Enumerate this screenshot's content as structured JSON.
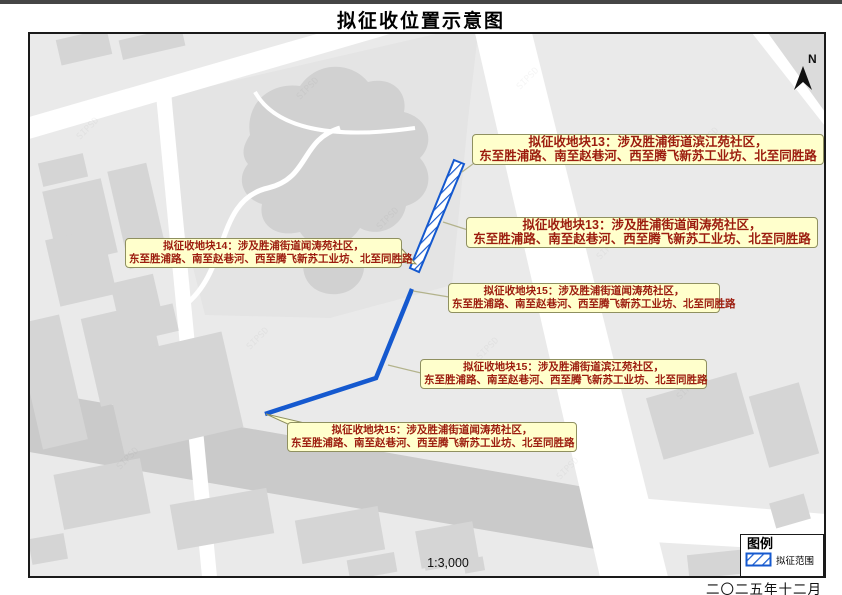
{
  "page": {
    "title": "拟征收位置示意图",
    "scale": "1:3,000",
    "north": "N",
    "date": "二〇二五年十二月"
  },
  "legend": {
    "title": "图例",
    "items": [
      {
        "label": "拟征范围",
        "swatch": "blue-diagonal-hatch"
      }
    ]
  },
  "map": {
    "watermark": "SIPSD",
    "callouts": [
      {
        "line1": "拟征收地块13：涉及胜浦街道滨江苑社区，",
        "line2": "东至胜浦路、南至赵巷河、西至腾飞新苏工业坊、北至同胜路"
      },
      {
        "line1": "拟征收地块13：涉及胜浦街道闻涛苑社区，",
        "line2": "东至胜浦路、南至赵巷河、西至腾飞新苏工业坊、北至同胜路"
      },
      {
        "line1": "拟征收地块14：涉及胜浦街道闻涛苑社区，",
        "line2": "东至胜浦路、南至赵巷河、西至腾飞新苏工业坊、北至同胜路"
      },
      {
        "line1": "拟征收地块15：涉及胜浦街道闻涛苑社区，",
        "line2": "东至胜浦路、南至赵巷河、西至腾飞新苏工业坊、北至同胜路"
      },
      {
        "line1": "拟征收地块15：涉及胜浦街道滨江苑社区，",
        "line2": "东至胜浦路、南至赵巷河、西至腾飞新苏工业坊、北至同胜路"
      },
      {
        "line1": "拟征收地块15：涉及胜浦街道闻涛苑社区，",
        "line2": "东至胜浦路、南至赵巷河、西至腾飞新苏工业坊、北至同胜路"
      }
    ]
  },
  "colors": {
    "acquisition_blue": "#1559cf",
    "callout_bg": "#ffffcc",
    "callout_border": "#8f9060",
    "callout_text": "#9c1c0e",
    "map_base": "#eaeaea",
    "road_white": "#ffffff",
    "building_gray": "#d5d5d5",
    "dark_road_gray": "#cacaca",
    "park_gray": "#e4e4e4",
    "park_blob_gray": "#d1d1d1"
  }
}
